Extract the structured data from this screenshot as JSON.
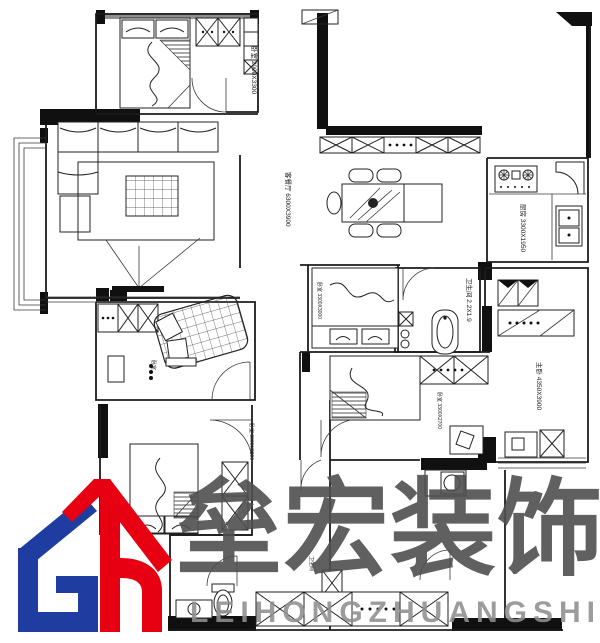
{
  "watermark": {
    "brand_cn": "垒宏装饰",
    "brand_en": "LEIHONGZHUANGSHI",
    "logo_blue": "#1f3da0",
    "logo_red": "#e60012"
  },
  "plan": {
    "rooms": [
      {
        "id": "bedroom-top-left",
        "label": "卧室 2900X3300"
      },
      {
        "id": "living-dining",
        "label": "客餐厅 6300X3900"
      },
      {
        "id": "kitchen",
        "label": "厨房 3300X1950"
      },
      {
        "id": "bath-main",
        "label": "卫生间 2.2X1.9"
      },
      {
        "id": "bedroom-middle",
        "label": "卧室 3300X3000"
      },
      {
        "id": "bedroom-bottom-left",
        "label": "卧室 3000X3300"
      },
      {
        "id": "bedroom-center",
        "label": "卧室 3300X2700"
      },
      {
        "id": "master-bedroom",
        "label": "主卧 4350X3900"
      },
      {
        "id": "bath-second",
        "label": "卫生间"
      },
      {
        "id": "bedroom-mid-left",
        "label": "卧室"
      }
    ]
  }
}
